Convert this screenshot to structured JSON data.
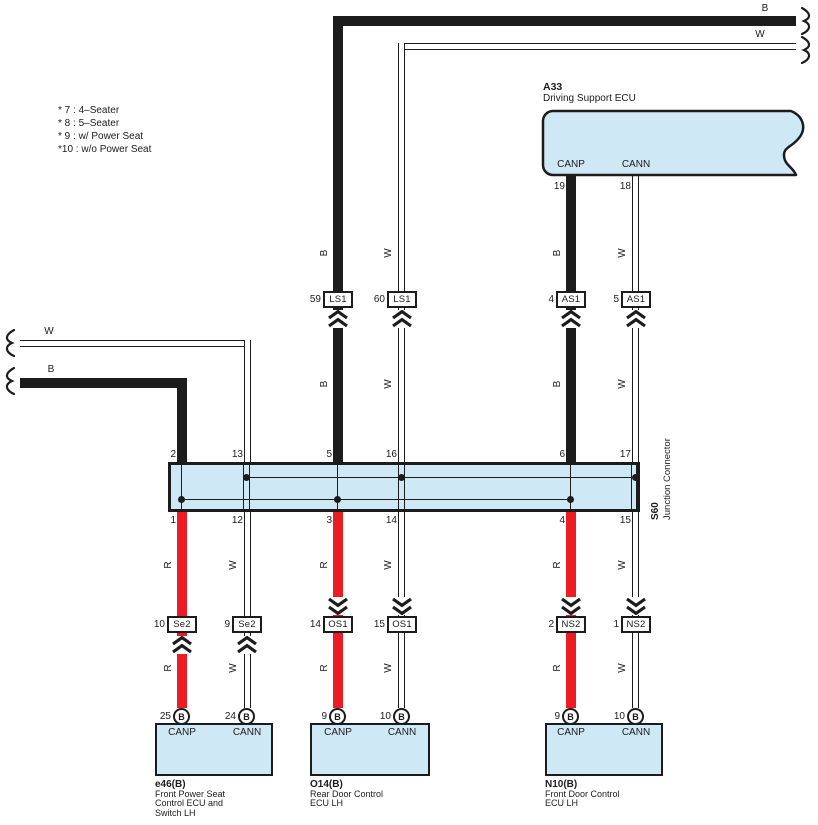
{
  "colors": {
    "fill": "#cfe8f5",
    "red": "#ec1c24",
    "line": "#1c1c1c",
    "bg": "#ffffff"
  },
  "legend": [
    "* 7 : 4–Seater",
    "* 8 : 5–Seater",
    "* 9 : w/ Power Seat",
    "*10 : w/o Power Seat"
  ],
  "wire_letters": {
    "B": "B",
    "W": "W",
    "R": "R"
  },
  "top_ecu": {
    "id": "A33",
    "name": "Driving Support ECU",
    "pins": [
      {
        "num": "19",
        "label": "CANP"
      },
      {
        "num": "18",
        "label": "CANN"
      }
    ]
  },
  "row1_connectors": [
    {
      "pin": "59",
      "id": "LS1"
    },
    {
      "pin": "60",
      "id": "LS1"
    },
    {
      "pin": "4",
      "id": "AS1"
    },
    {
      "pin": "5",
      "id": "AS1"
    }
  ],
  "junction": {
    "id": "S60",
    "name": "Junction Connector",
    "top_pins": [
      "2",
      "13",
      "5",
      "16",
      "6",
      "17"
    ],
    "bottom_pins": [
      "1",
      "12",
      "3",
      "14",
      "4",
      "15"
    ]
  },
  "row2_connectors": [
    {
      "pin": "10",
      "id": "Se2"
    },
    {
      "pin": "9",
      "id": "Se2"
    },
    {
      "pin": "14",
      "id": "OS1"
    },
    {
      "pin": "15",
      "id": "OS1"
    },
    {
      "pin": "2",
      "id": "NS2"
    },
    {
      "pin": "1",
      "id": "NS2"
    }
  ],
  "ecus": [
    {
      "id": "e46(B)",
      "name_lines": [
        "Front Power Seat",
        "Control ECU and",
        "Switch LH"
      ],
      "pins": [
        {
          "num": "25",
          "code": "B",
          "label": "CANP"
        },
        {
          "num": "24",
          "code": "B",
          "label": "CANN"
        }
      ]
    },
    {
      "id": "O14(B)",
      "name_lines": [
        "Rear Door Control",
        "ECU LH"
      ],
      "pins": [
        {
          "num": "9",
          "code": "B",
          "label": "CANP"
        },
        {
          "num": "10",
          "code": "B",
          "label": "CANN"
        }
      ]
    },
    {
      "id": "N10(B)",
      "name_lines": [
        "Front Door Control",
        "ECU LH"
      ],
      "pins": [
        {
          "num": "9",
          "code": "B",
          "label": "CANP"
        },
        {
          "num": "10",
          "code": "B",
          "label": "CANN"
        }
      ]
    }
  ]
}
